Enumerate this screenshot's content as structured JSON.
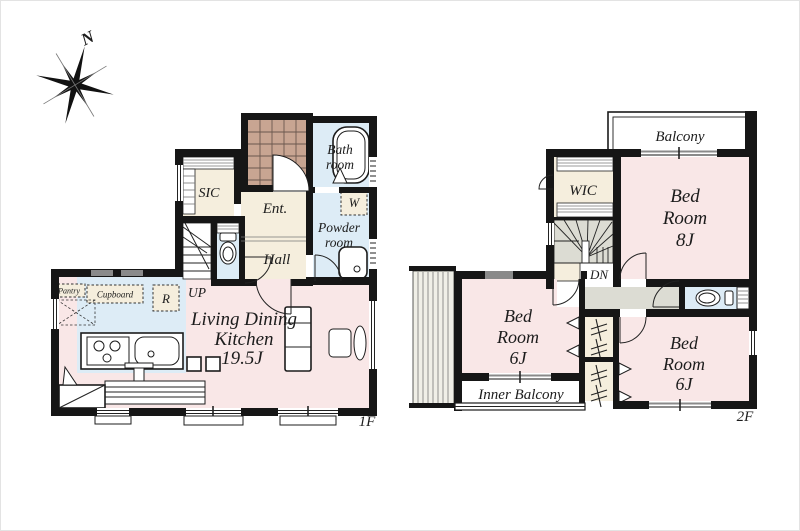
{
  "compass": {
    "north_label": "N"
  },
  "floor1": {
    "floor_label": "1F",
    "sic": "SIC",
    "ent": "Ent.",
    "bath": [
      "Bath",
      "room"
    ],
    "washer": "W",
    "powder": [
      "Powder",
      "room"
    ],
    "hall": "Hall",
    "up": "UP",
    "pantry": "Pantry",
    "cupboard": "Cupboard",
    "fridge": "R",
    "ldk": [
      "Living Dining",
      "Kitchen",
      "19.5J"
    ]
  },
  "floor2": {
    "floor_label": "2F",
    "balcony": "Balcony",
    "wic": "WIC",
    "bed8": [
      "Bed",
      "Room",
      "8J"
    ],
    "down": "DN",
    "bed6_left": [
      "Bed",
      "Room",
      "6J"
    ],
    "bed6_right": [
      "Bed",
      "Room",
      "6J"
    ],
    "inner_balcony": "Inner Balcony"
  },
  "colors": {
    "wall": "#161616",
    "room_pink": "#f9e7e7",
    "water_blue": "#ddecf6",
    "wood_beige": "#f5eedd",
    "hall_gray": "#dcdcd3",
    "tile_brown": "#c8a592",
    "window_gray": "#8a8a8a"
  }
}
